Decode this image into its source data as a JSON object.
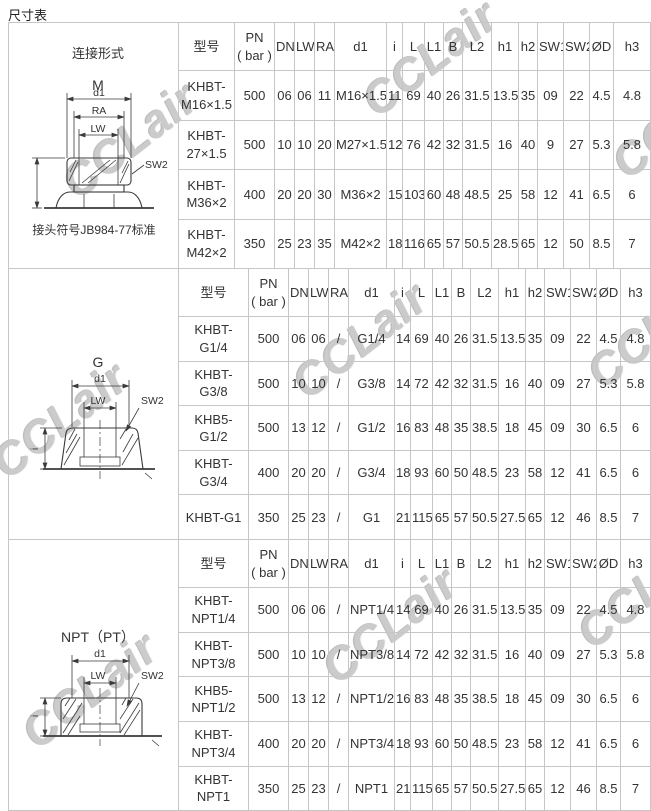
{
  "page": {
    "title": "尺寸表"
  },
  "colors": {
    "border": "#c6c6c6",
    "text": "#333333",
    "watermark": "#cbcbcb"
  },
  "watermark": {
    "text": "CCLair",
    "positions": [
      [
        130,
        140
      ],
      [
        430,
        58
      ],
      [
        680,
        120
      ],
      [
        60,
        420
      ],
      [
        360,
        340
      ],
      [
        655,
        330
      ],
      [
        90,
        690
      ],
      [
        390,
        625
      ],
      [
        645,
        590
      ]
    ]
  },
  "columns": [
    "型号",
    "PN\n( bar )",
    "DN",
    "LW",
    "RA",
    "d1",
    "i",
    "L",
    "L1",
    "B",
    "L2",
    "h1",
    "h2",
    "SW1",
    "SW2",
    "ØD",
    "h3"
  ],
  "sections": [
    {
      "diagram": {
        "form_label": "连接形式",
        "thread_label": "M",
        "labels": {
          "d1": "d1",
          "ra": "RA",
          "lw": "LW",
          "sw2": "SW2"
        },
        "note": "接头符号JB984-77标准"
      },
      "rows": [
        [
          "KHBT-\nM16×1.5",
          "500",
          "06",
          "06",
          "11",
          "M16×1.5",
          "11",
          "69",
          "40",
          "26",
          "31.5",
          "13.5",
          "35",
          "09",
          "22",
          "4.5",
          "4.8"
        ],
        [
          "KHBT-\n27×1.5",
          "500",
          "10",
          "10",
          "20",
          "M27×1.5",
          "12",
          "76",
          "42",
          "32",
          "31.5",
          "16",
          "40",
          "9",
          "27",
          "5.3",
          "5.8"
        ],
        [
          "KHBT-\nM36×2",
          "400",
          "20",
          "20",
          "30",
          "M36×2",
          "15",
          "103",
          "60",
          "48",
          "48.5",
          "25",
          "58",
          "12",
          "41",
          "6.5",
          "6"
        ],
        [
          "KHBT-\nM42×2",
          "350",
          "25",
          "23",
          "35",
          "M42×2",
          "18",
          "116",
          "65",
          "57",
          "50.5",
          "28.5",
          "65",
          "12",
          "50",
          "8.5",
          "7"
        ]
      ]
    },
    {
      "diagram": {
        "thread_label": "G",
        "labels": {
          "d1": "d1",
          "lw": "LW",
          "sw2": "SW2",
          "i": "i"
        }
      },
      "rows": [
        [
          "KHBT-\nG1/4",
          "500",
          "06",
          "06",
          "/",
          "G1/4",
          "14",
          "69",
          "40",
          "26",
          "31.5",
          "13.5",
          "35",
          "09",
          "22",
          "4.5",
          "4.8"
        ],
        [
          "KHBT-\nG3/8",
          "500",
          "10",
          "10",
          "/",
          "G3/8",
          "14",
          "72",
          "42",
          "32",
          "31.5",
          "16",
          "40",
          "09",
          "27",
          "5.3",
          "5.8"
        ],
        [
          "KHB5-\nG1/2",
          "500",
          "13",
          "12",
          "/",
          "G1/2",
          "16",
          "83",
          "48",
          "35",
          "38.5",
          "18",
          "45",
          "09",
          "30",
          "6.5",
          "6"
        ],
        [
          "KHBT-\nG3/4",
          "400",
          "20",
          "20",
          "/",
          "G3/4",
          "18",
          "93",
          "60",
          "50",
          "48.5",
          "23",
          "58",
          "12",
          "41",
          "6.5",
          "6"
        ],
        [
          "KHBT-G1",
          "350",
          "25",
          "23",
          "/",
          "G1",
          "21",
          "115",
          "65",
          "57",
          "50.5",
          "27.5",
          "65",
          "12",
          "46",
          "8.5",
          "7"
        ]
      ]
    },
    {
      "diagram": {
        "thread_label": "NPT（PT）",
        "labels": {
          "d1": "d1",
          "lw": "LW",
          "sw2": "SW2",
          "i": "i"
        }
      },
      "rows": [
        [
          "KHBT-\nNPT1/4",
          "500",
          "06",
          "06",
          "/",
          "NPT1/4",
          "14",
          "69",
          "40",
          "26",
          "31.5",
          "13.5",
          "35",
          "09",
          "22",
          "4.5",
          "4.8"
        ],
        [
          "KHBT-\nNPT3/8",
          "500",
          "10",
          "10",
          "/",
          "NPT3/8",
          "14",
          "72",
          "42",
          "32",
          "31.5",
          "16",
          "40",
          "09",
          "27",
          "5.3",
          "5.8"
        ],
        [
          "KHB5-\nNPT1/2",
          "500",
          "13",
          "12",
          "/",
          "NPT1/2",
          "16",
          "83",
          "48",
          "35",
          "38.5",
          "18",
          "45",
          "09",
          "30",
          "6.5",
          "6"
        ],
        [
          "KHBT-\nNPT3/4",
          "400",
          "20",
          "20",
          "/",
          "NPT3/4",
          "18",
          "93",
          "60",
          "50",
          "48.5",
          "23",
          "58",
          "12",
          "41",
          "6.5",
          "6"
        ],
        [
          "KHBT-NPT1",
          "350",
          "25",
          "23",
          "/",
          "NPT1",
          "21",
          "115",
          "65",
          "57",
          "50.5",
          "27.5",
          "65",
          "12",
          "46",
          "8.5",
          "7"
        ]
      ]
    }
  ]
}
